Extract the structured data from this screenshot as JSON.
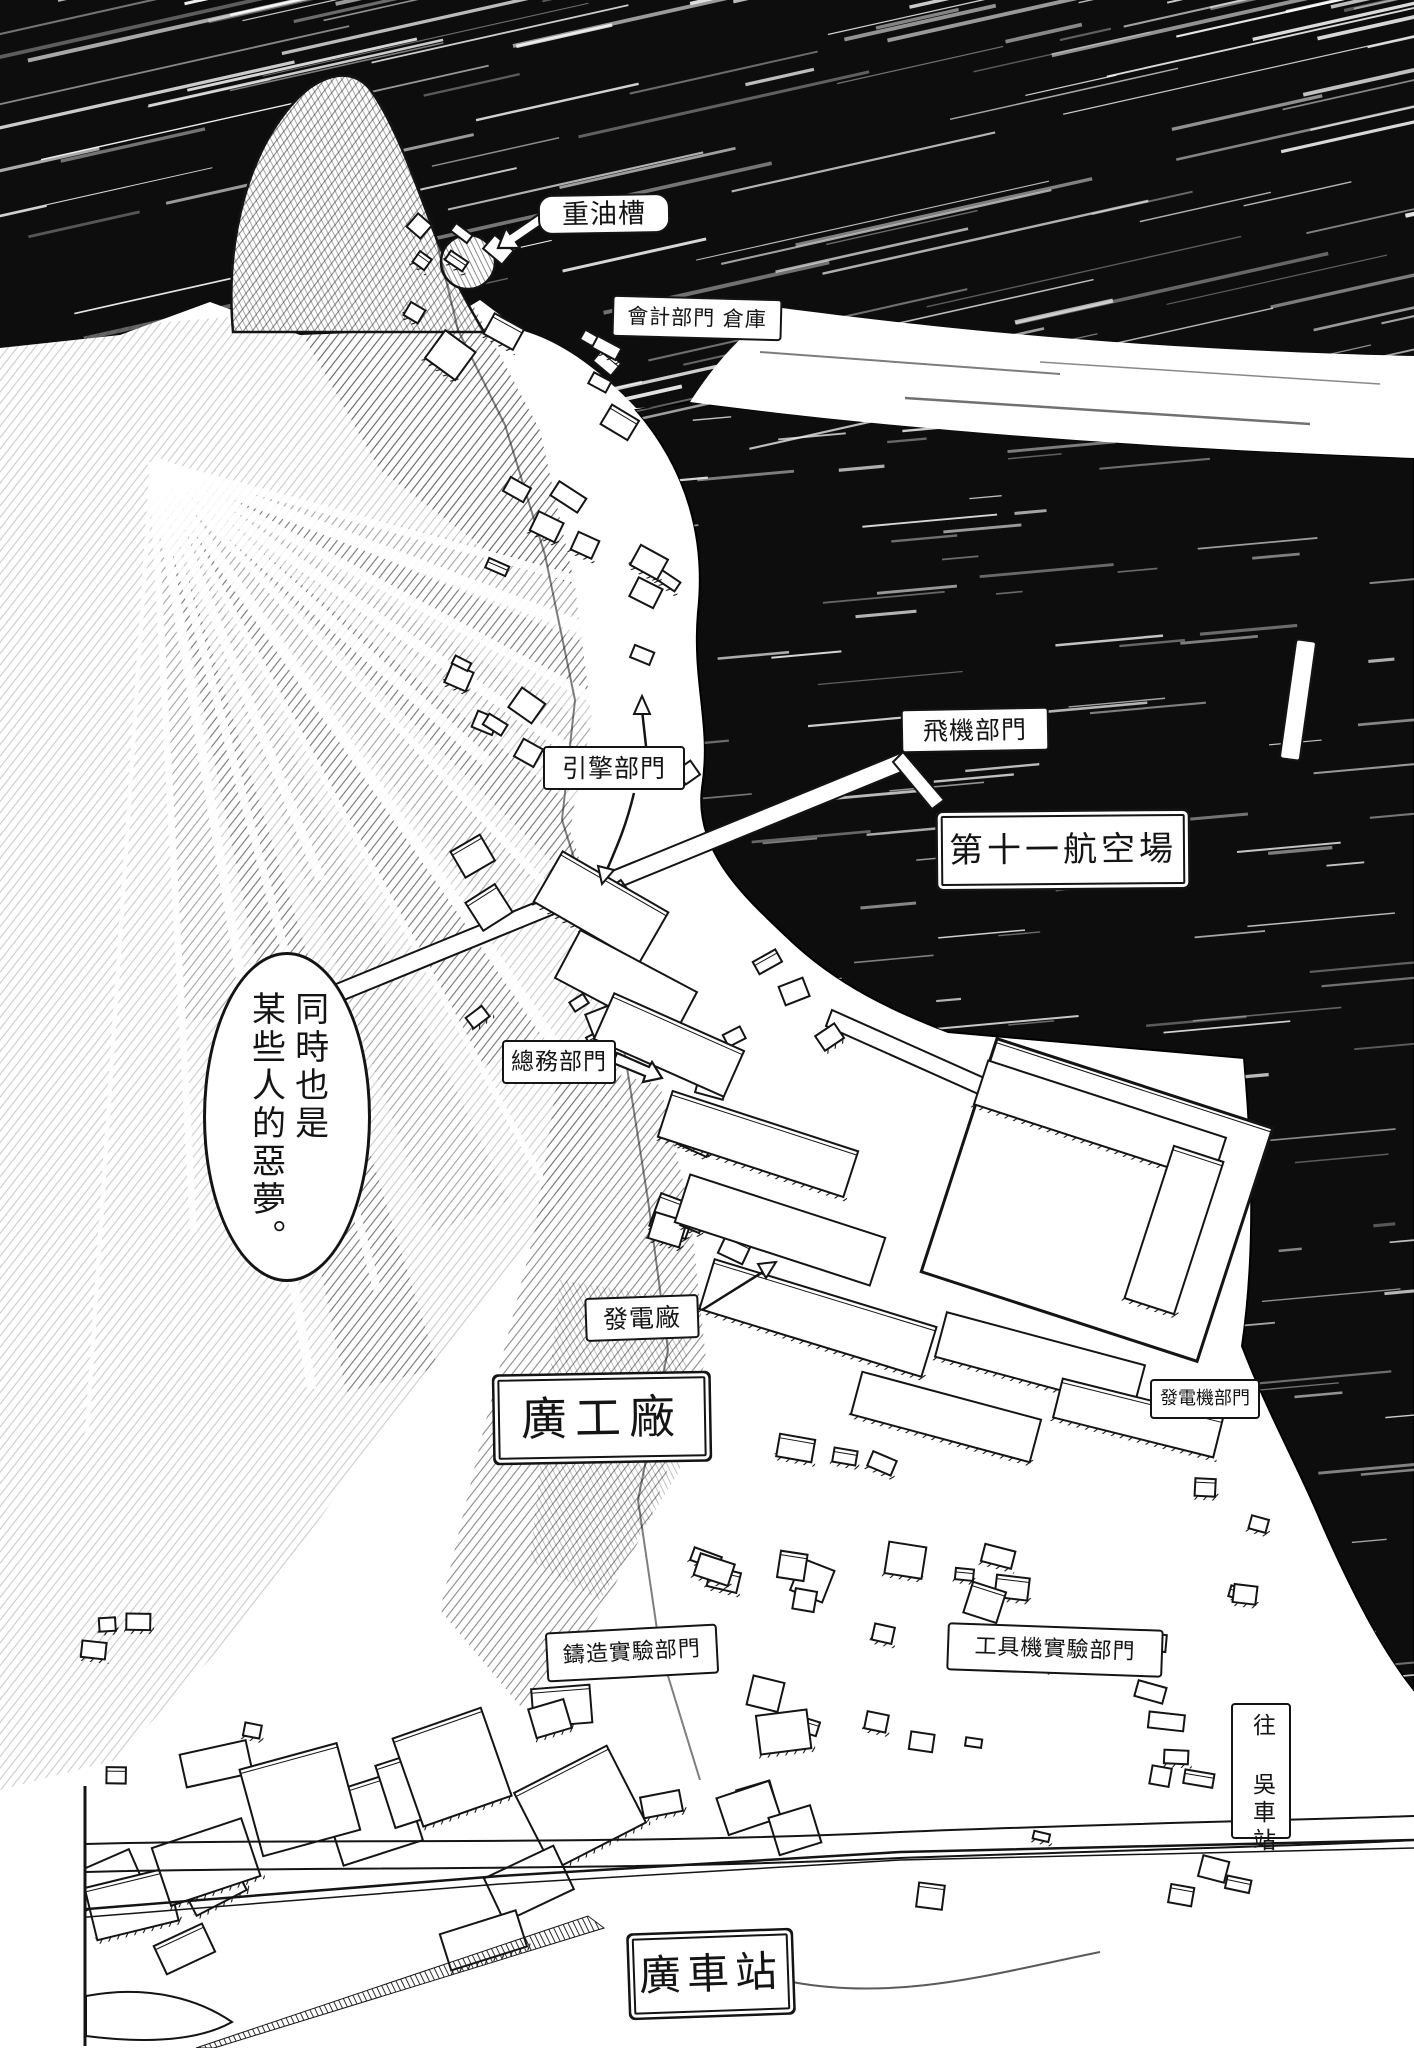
{
  "artwork": {
    "type": "hand-drawn manga aerial map of a harbour factory town",
    "colors": {
      "ink": "#141414",
      "paper": "#ffffff",
      "sea": "#0d0d0d"
    }
  },
  "speech_bubble": {
    "text": "同時也是某些人的惡夢。",
    "column_right": "同時也是",
    "column_left": "某些人的惡夢。"
  },
  "labels": {
    "fuel_tank": "重油槽",
    "accounting_dept_warehouse": "會計部門 倉庫",
    "engine_dept": "引擎部門",
    "aircraft_dept": "飛機部門",
    "eleventh_airfield": "第十一航空場",
    "general_affairs_dept": "總務部門",
    "power_plant": "發電廠",
    "hiro_factory": "廣工廠",
    "generator_dept": "發電機部門",
    "casting_experiment_dept": "鑄造實驗部門",
    "machine_tool_experiment_dept": "工具機實驗部門",
    "to_kure_station": "往 吳車站",
    "hiro_station": "廣車站"
  }
}
